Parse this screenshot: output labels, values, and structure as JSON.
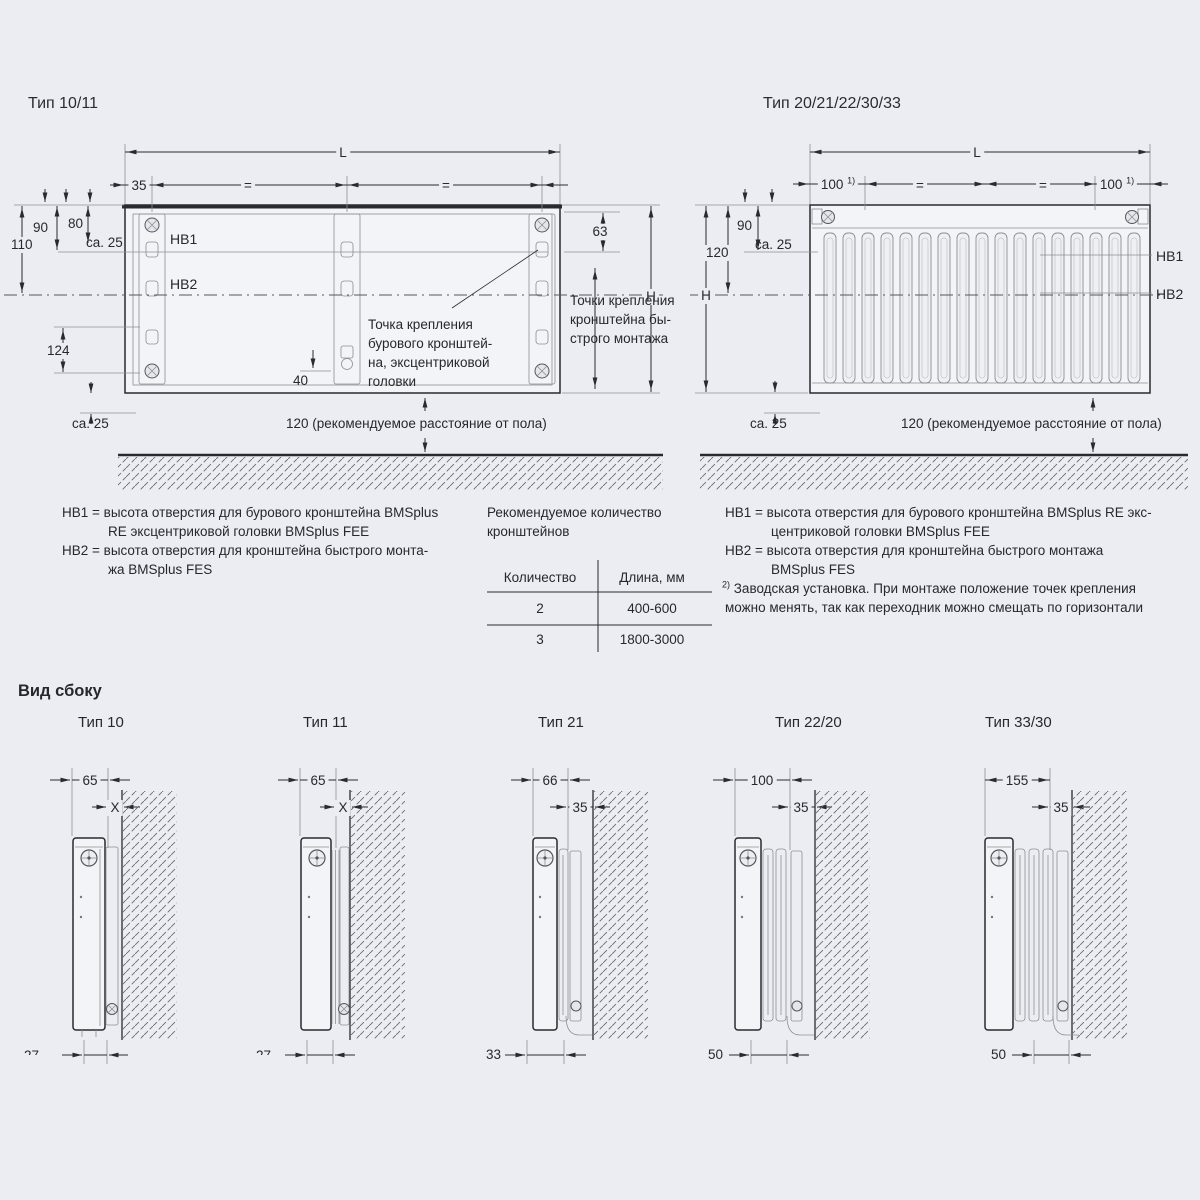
{
  "colors": {
    "bg": "#ecedf2",
    "line": "#2a2a2e",
    "gray_line": "#8d8e94",
    "text": "#27272c"
  },
  "tl": {
    "title": "Тип 10/11",
    "L": "L",
    "d35": "35",
    "eq1": "=",
    "eq2": "=",
    "d90": "90",
    "d80": "80",
    "d110": "110",
    "ca25a": "ca. 25",
    "hb1": "HB1",
    "hb2": "HB2",
    "d124": "124",
    "ca25b": "ca. 25",
    "d63": "63",
    "H": "H",
    "d40": "40",
    "note_drill": "Точка крепления\nбурового кронштей-\nна, эксцентриковой\nголовки",
    "note_quick": "Точки крепления\nкронштейна бы-\nстрого монтажа",
    "floor_note": "120 (рекомендуемое расстояние от пола)"
  },
  "tr": {
    "title": "Тип 20/21/22/30/33",
    "L": "L",
    "n100a": "100",
    "supa": "1)",
    "eq1": "=",
    "eq2": "=",
    "n100b": "100",
    "supb": "1)",
    "d90": "90",
    "d120": "120",
    "ca25a": "ca. 25",
    "H": "H",
    "hb1": "HB1",
    "hb2": "HB2",
    "ca25b": "ca. 25",
    "floor_note": "120 (рекомендуемое расстояние от пола)"
  },
  "ll": {
    "l1": "HB1 = высота отверстия для бурового кронштейна BMSplus",
    "l2": "RE эксцентриковой головки BMSplus FEE",
    "l3": "HB2 = высота отверстия для кронштейна быстрого монта-",
    "l4": "жа BMSplus FES"
  },
  "tb": {
    "cap1": "Рекомендуемое количество",
    "cap2": "кронштейнов",
    "col_qty": "Количество",
    "col_len": "Длина, мм",
    "rows": [
      {
        "qty": "2",
        "len": "400-600"
      },
      {
        "qty": "3",
        "len": "1800-3000"
      }
    ]
  },
  "lr": {
    "l1": "HB1 = высота отверстия для бурового кронштейна BMSplus RE экс-",
    "l2": "центриковой головки BMSplus FEE",
    "l3": "HB2 = высота отверстия для кронштейна быстрого монтажа",
    "l4": "BMSplus FES",
    "fmark": "2)",
    "f1": "Заводская установка. При монтаже положение точек крепления",
    "f2": "можно менять, так как переходник можно смещать по горизонтали"
  },
  "sv": {
    "header": "Вид сбоку",
    "views": [
      {
        "title": "Тип 10",
        "depth": "65",
        "offset": "X",
        "bottom": "27"
      },
      {
        "title": "Тип 11",
        "depth": "65",
        "offset": "X",
        "bottom": "27"
      },
      {
        "title": "Тип 21",
        "depth": "66",
        "offset": "35",
        "bottom": "33"
      },
      {
        "title": "Тип 22/20",
        "depth": "100",
        "offset": "35",
        "bottom": "50"
      },
      {
        "title": "Тип 33/30",
        "depth": "155",
        "offset": "35",
        "bottom": "50"
      }
    ]
  }
}
